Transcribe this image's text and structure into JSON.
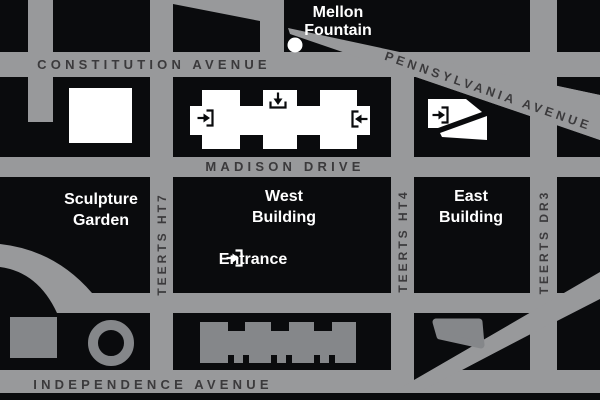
{
  "colors": {
    "street_gray": "#98999b",
    "block_black": "#0a0b0d",
    "street_label_dark": "#3b3a3c",
    "building_footprint_gray": "#85878a",
    "white": "#ffffff"
  },
  "streets": {
    "constitution": "CONSTITUTION AVENUE",
    "pennsylvania": "PENNSYLVANIA AVENUE",
    "madison": "MADISON DRIVE",
    "independence": "INDEPENDENCE AVENUE",
    "seventh": "7TH STREET",
    "fourth": "4TH STREET",
    "third": "3RD STREET"
  },
  "landmarks": {
    "mellon": {
      "line1": "Mellon",
      "line2": "Fountain"
    },
    "sculpture_garden": {
      "line1": "Sculpture",
      "line2": "Garden"
    },
    "west_building": {
      "line1": "West",
      "line2": "Building"
    },
    "east_building": {
      "line1": "East",
      "line2": "Building"
    },
    "entrance": "Entrance"
  }
}
